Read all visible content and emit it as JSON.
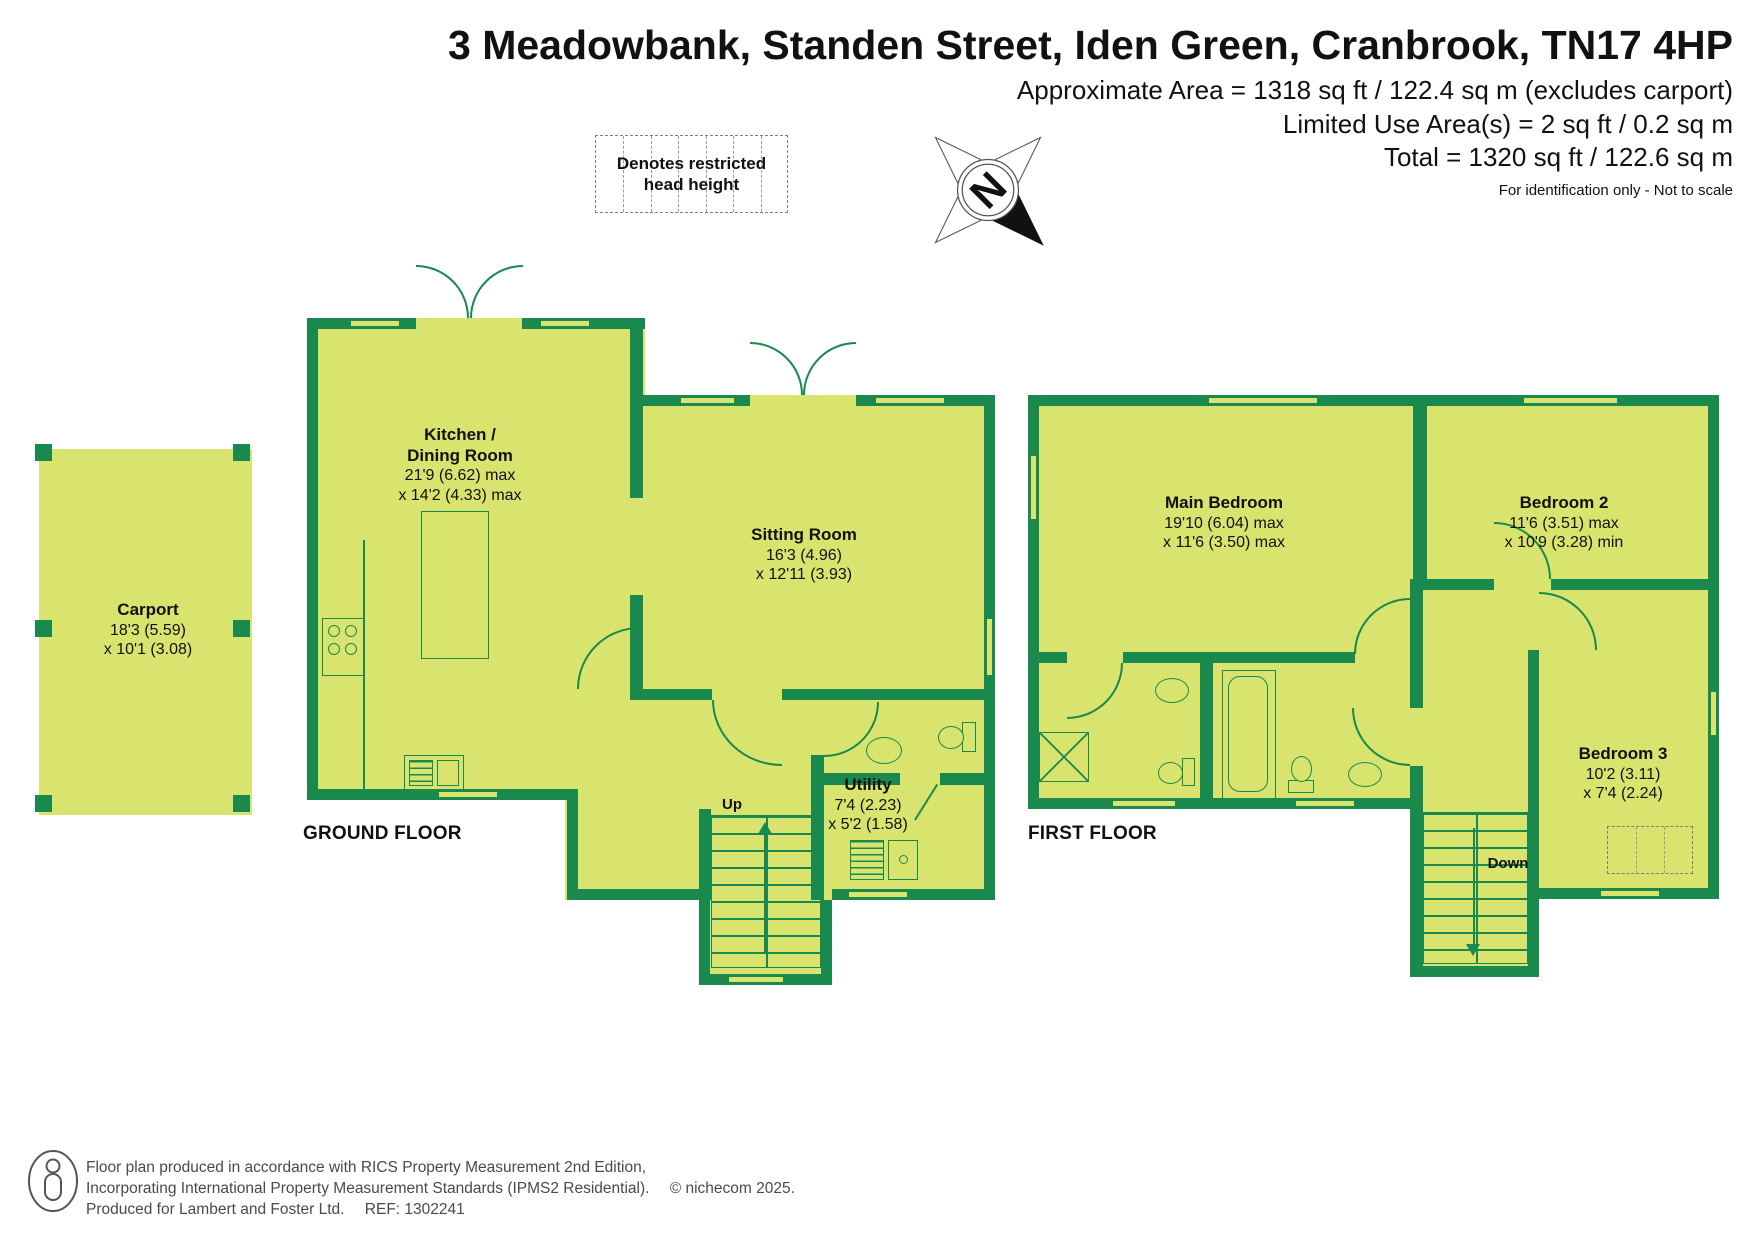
{
  "header": {
    "title": "3 Meadowbank, Standen Street, Iden Green, Cranbrook, TN17 4HP",
    "area_line1": "Approximate Area = 1318 sq ft / 122.4 sq m (excludes carport)",
    "area_line2": "Limited Use Area(s) = 2 sq ft / 0.2 sq m",
    "area_line3": "Total = 1320 sq ft / 122.6 sq m",
    "disclaimer": "For identification only - Not to scale"
  },
  "legend": {
    "restricted_head_height": "Denotes restricted head height"
  },
  "compass": {
    "north_label": "N"
  },
  "floors": {
    "ground": {
      "label": "GROUND FLOOR"
    },
    "first": {
      "label": "FIRST FLOOR"
    }
  },
  "rooms": {
    "kitchen": {
      "name_line1": "Kitchen /",
      "name_line2": "Dining Room",
      "dim_line1": "21'9 (6.62) max",
      "dim_line2": "x 14'2 (4.33) max"
    },
    "sitting": {
      "name": "Sitting Room",
      "dim_line1": "16'3 (4.96)",
      "dim_line2": "x 12'11 (3.93)"
    },
    "utility": {
      "name": "Utility",
      "dim_line1": "7'4 (2.23)",
      "dim_line2": "x 5'2 (1.58)"
    },
    "carport": {
      "name": "Carport",
      "dim_line1": "18'3 (5.59)",
      "dim_line2": "x 10'1 (3.08)"
    },
    "main_bedroom": {
      "name": "Main Bedroom",
      "dim_line1": "19'10 (6.04) max",
      "dim_line2": "x 11'6 (3.50) max"
    },
    "bedroom2": {
      "name": "Bedroom 2",
      "dim_line1": "11'6 (3.51) max",
      "dim_line2": "x 10'9 (3.28) min"
    },
    "bedroom3": {
      "name": "Bedroom 3",
      "dim_line1": "10'2 (3.11)",
      "dim_line2": "x 7'4 (2.24)"
    }
  },
  "stairs": {
    "up_label": "Up",
    "down_label": "Down"
  },
  "footer": {
    "line1": "Floor plan produced in accordance with RICS Property Measurement 2nd Edition,",
    "line2": "Incorporating International Property Measurement Standards (IPMS2 Residential).",
    "copyright": "© nichecom 2025.",
    "line3": "Produced for Lambert and Foster Ltd.",
    "ref": "REF: 1302241"
  },
  "colors": {
    "room_fill": "#d9e46e",
    "wall_green": "#19894d"
  }
}
